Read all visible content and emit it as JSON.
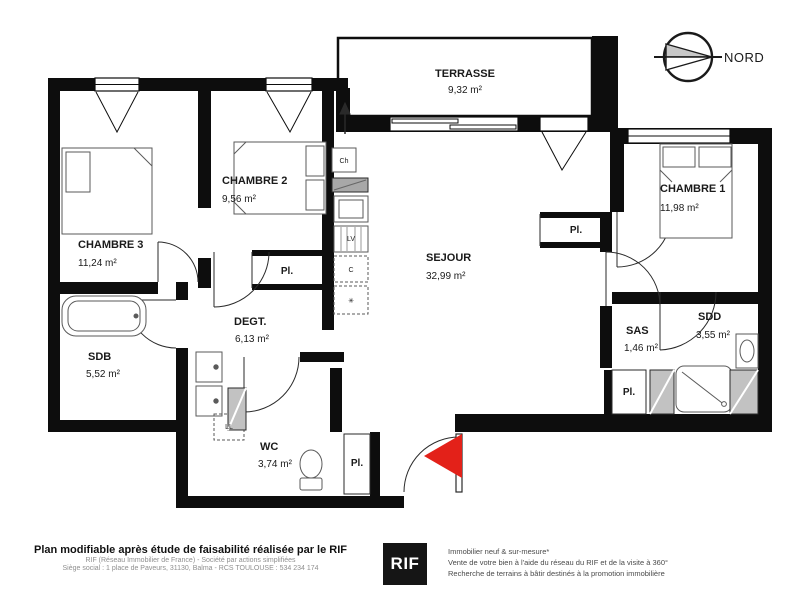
{
  "compass": {
    "label": "NORD"
  },
  "rooms": {
    "terrasse": {
      "name": "TERRASSE",
      "area": "9,32 m²"
    },
    "chambre2": {
      "name": "CHAMBRE 2",
      "area": "9,56 m²"
    },
    "chambre3": {
      "name": "CHAMBRE 3",
      "area": "11,24 m²"
    },
    "chambre1": {
      "name": "CHAMBRE 1",
      "area": "11,98 m²"
    },
    "sejour": {
      "name": "SEJOUR",
      "area": "32,99 m²"
    },
    "sdb": {
      "name": "SDB",
      "area": "5,52 m²"
    },
    "degt": {
      "name": "DEGT.",
      "area": "6,13 m²"
    },
    "wc": {
      "name": "WC",
      "area": "3,74 m²"
    },
    "sas": {
      "name": "SAS",
      "area": "1,46 m²"
    },
    "sdd": {
      "name": "SDD",
      "area": "3,55 m²"
    }
  },
  "labels": {
    "placard": "Pl.",
    "water_heater": "Ch",
    "dishwasher": "LV",
    "cooker": "C",
    "fridge": "✳",
    "washing_machine": "LL"
  },
  "footer": {
    "left_bold": "Plan modifiable après étude de faisabilité réalisée par le RIF",
    "left_line1": "RIF (Réseau Immobilier de France) - Société par actions simplifiées",
    "left_line2": "Siège social : 1 place de Paveurs, 31130, Balma - RCS TOULOUSE : 534 234 174",
    "logo": "RIF",
    "right_line1": "Immobilier neuf & sur-mesure*",
    "right_line2": "Vente de votre bien à l'aide du réseau du RIF et de la visite à 360°",
    "right_line3": "Recherche de terrains à bâtir destinés à la promotion immobilière"
  },
  "colors": {
    "wall": "#0d0d0d",
    "entry_arrow_red": "#e32119",
    "hatch_gray": "#c2c2c2",
    "counter_gray": "#a8a8a8"
  }
}
